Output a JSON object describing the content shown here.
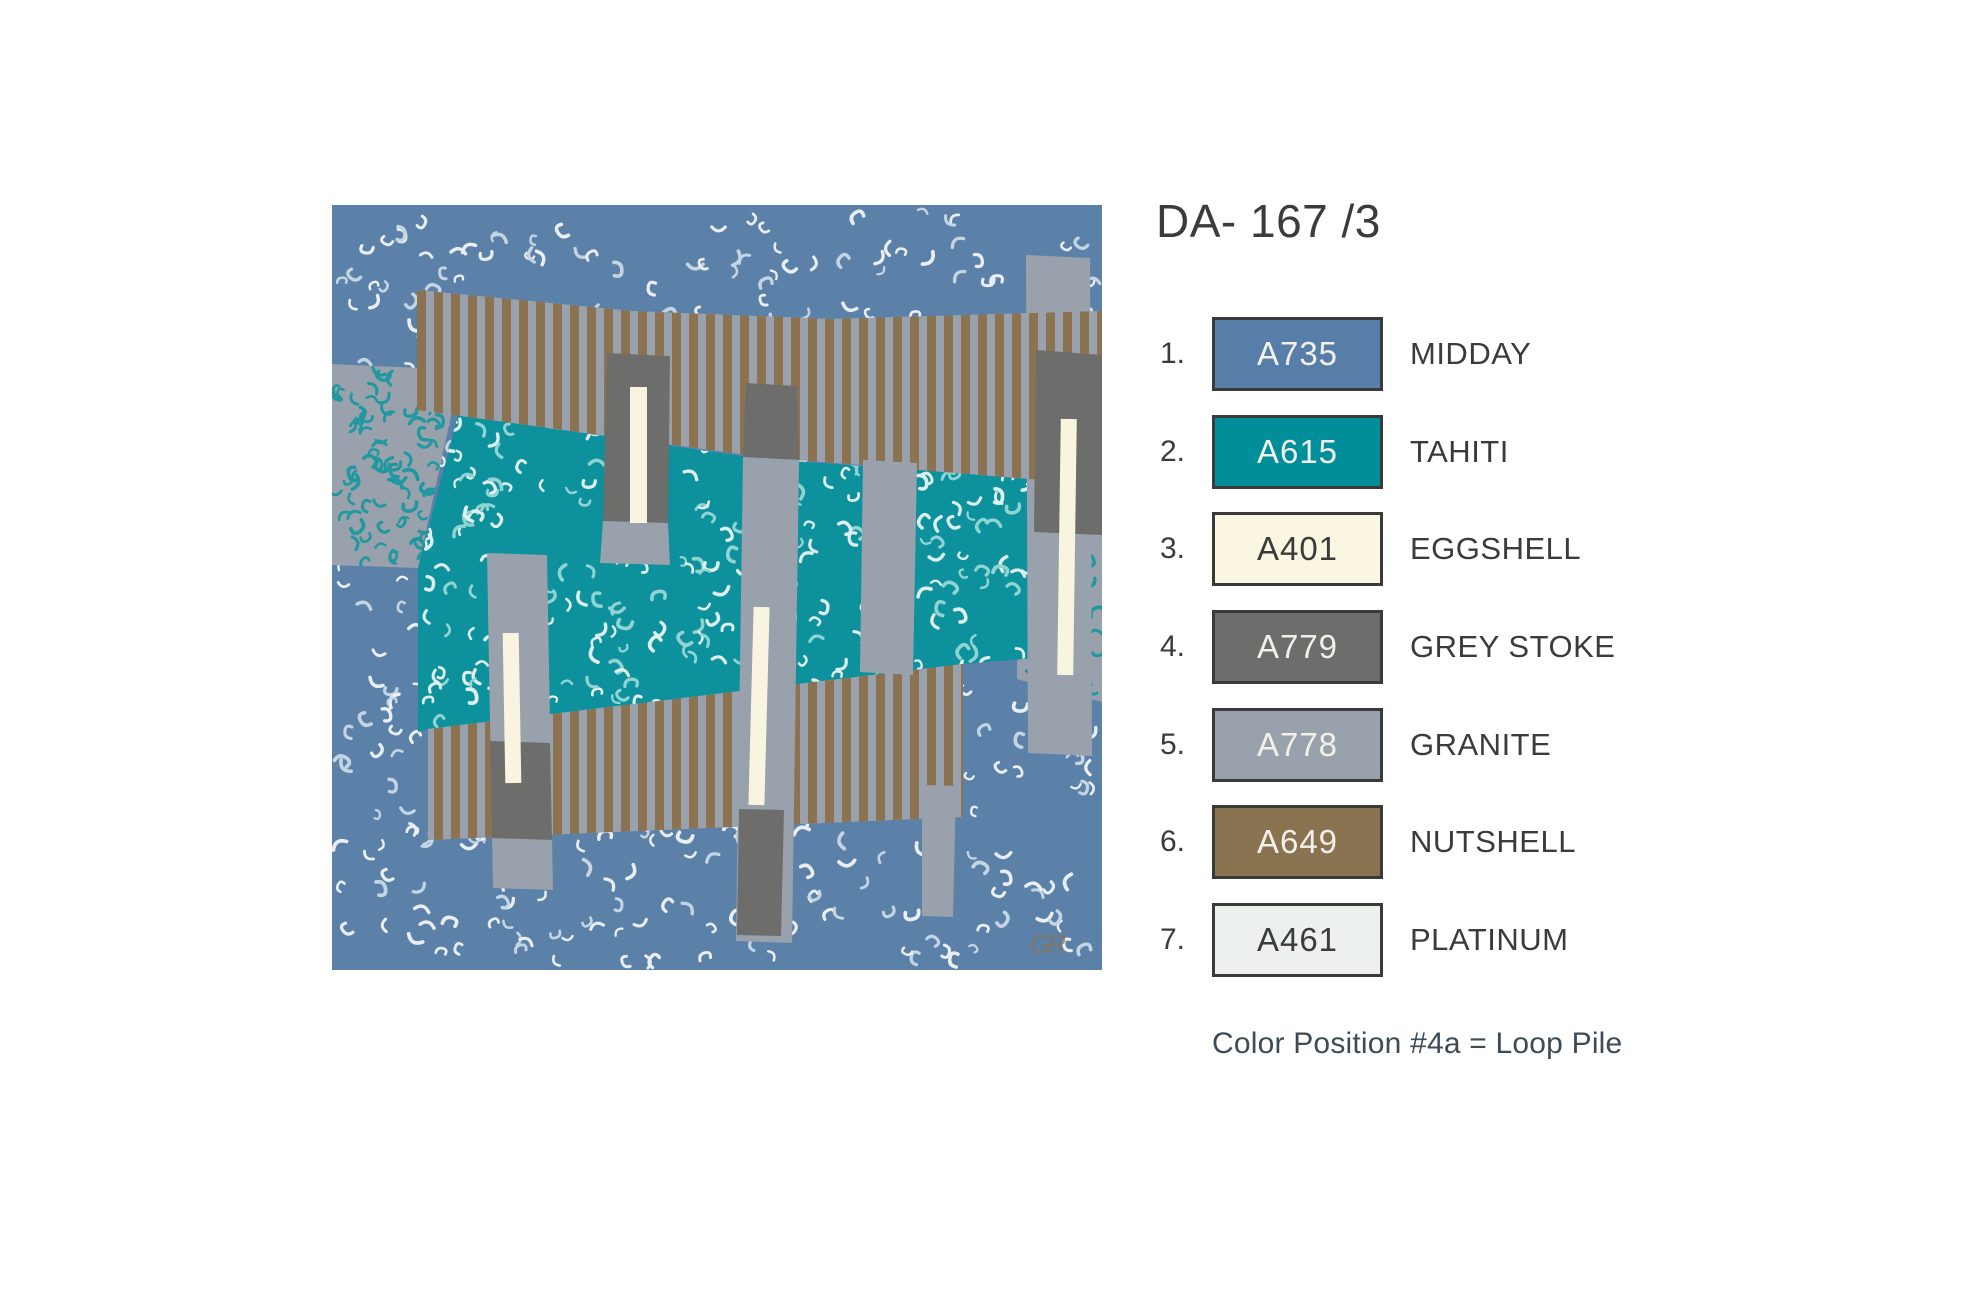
{
  "title": "DA- 167 /3",
  "ui": {
    "text_color": "#3b3b3b",
    "note_color": "#3e4a56",
    "swatch_border": "#3a3a38"
  },
  "legend": {
    "items": [
      {
        "num": "1.",
        "code": "A735",
        "name": "MIDDAY",
        "color": "#567ea9",
        "text_color": "#f3f0e9"
      },
      {
        "num": "2.",
        "code": "A615",
        "name": "TAHITI",
        "color": "#008e9b",
        "text_color": "#f3f0e9"
      },
      {
        "num": "3.",
        "code": "A401",
        "name": "EGGSHELL",
        "color": "#faf6e2",
        "text_color": "#3b3b3b"
      },
      {
        "num": "4.",
        "code": "A779",
        "name": "GREY STOKE",
        "color": "#6d6d6b",
        "text_color": "#f3f0e9"
      },
      {
        "num": "5.",
        "code": "A778",
        "name": "GRANITE",
        "color": "#99a1ad",
        "text_color": "#f3f0e9"
      },
      {
        "num": "6.",
        "code": "A649",
        "name": "NUTSHELL",
        "color": "#8a7351",
        "text_color": "#f3f0e9"
      },
      {
        "num": "7.",
        "code": "A461",
        "name": "PLATINUM",
        "color": "#edf1ed",
        "text_color": "#3b3b3b"
      }
    ]
  },
  "note": "Color Position #4a = Loop Pile",
  "design": {
    "watermark": "GR",
    "colors": {
      "midday": "#5b81a9",
      "tahiti": "#0d919c",
      "eggshell": "#f8f4e0",
      "grey_stoke": "#6d6d6b",
      "granite": "#99a1ad",
      "nutshell": "#8b7352",
      "squiggle_on_blue": [
        "#e9eef3",
        "#c3d4e2"
      ],
      "squiggle_on_teal": [
        "#ddf0ee",
        "#8fd4d2"
      ],
      "squiggle_on_grey": "#1f98a0",
      "watermark_color": "#8a7352"
    }
  }
}
